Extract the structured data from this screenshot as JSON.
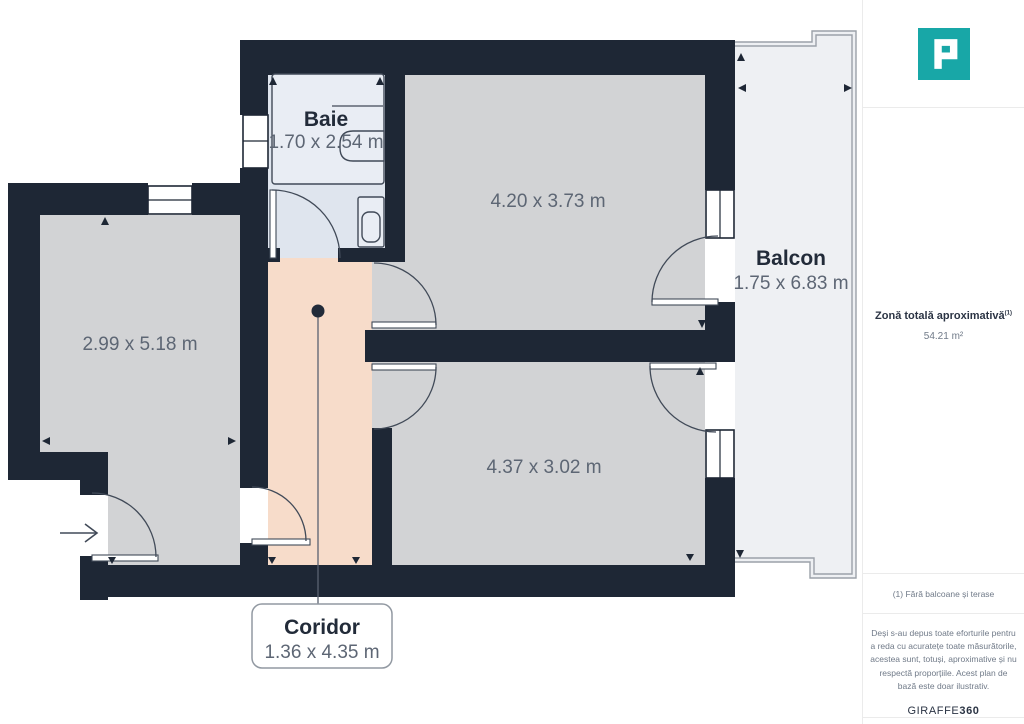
{
  "floorplan": {
    "rooms": {
      "baie": {
        "name": "Baie",
        "dimensions": "1.70 x 2.54 m"
      },
      "bedroom_top": {
        "dimensions": "4.20 x 3.73 m"
      },
      "balcon": {
        "name": "Balcon",
        "dimensions": "1.75 x 6.83 m"
      },
      "room_left": {
        "dimensions": "2.99 x 5.18 m"
      },
      "bedroom_bottom": {
        "dimensions": "4.37 x 3.02 m"
      },
      "coridor": {
        "name": "Coridor",
        "dimensions": "1.36 x 4.35 m"
      }
    },
    "colors": {
      "wall": "#1e2735",
      "room_floor": "#d2d3d5",
      "bath_floor": "#dfe5ee",
      "corridor_floor": "#f7dcca",
      "balcony_floor": "#eef0f3"
    }
  },
  "sidebar": {
    "logo_color": "#18a7a7",
    "total_area": {
      "label": "Zonă totală aproximativă",
      "footnote_marker": "(1)",
      "value": "54.21 m²"
    },
    "footnote": "(1) Fără balcoane și terase",
    "disclaimer": "Deși s-au depus toate eforturile pentru a reda cu acuratețe toate măsurătorile, acestea sunt, totuși, aproximative și nu respectă proporțiile. Acest plan de bază este doar ilustrativ.",
    "brand": {
      "regular": "GIRAFFE",
      "bold": "360"
    }
  }
}
